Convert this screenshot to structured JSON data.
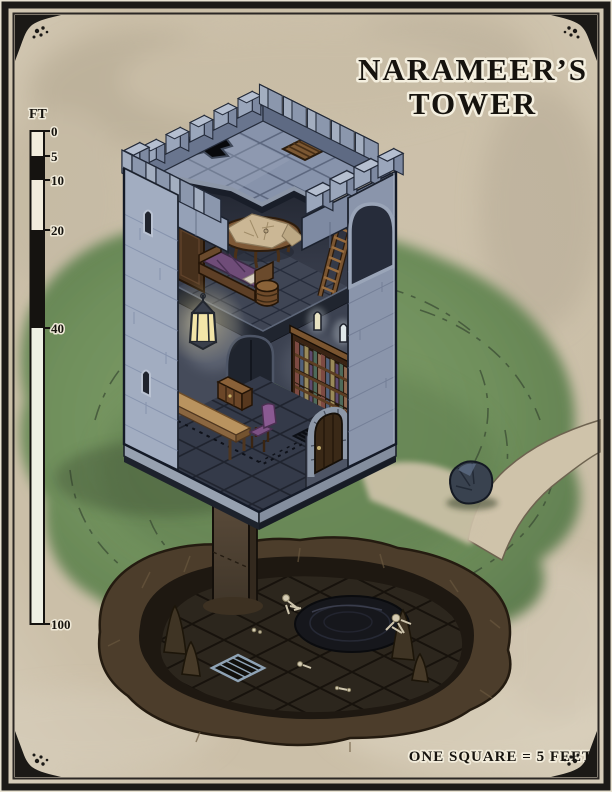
{
  "title": {
    "line1": "NARAMEER’S",
    "line2": "TOWER"
  },
  "legend": {
    "text": "ONE SQUARE = 5 FEET"
  },
  "scale_bar": {
    "unit": "FT",
    "ticks": [
      "0",
      "5",
      "10",
      "20",
      "40",
      "100"
    ],
    "segment_pattern": [
      "light",
      "dark",
      "light",
      "dark",
      "light"
    ]
  },
  "features": {
    "tower": [
      "crenellated-battlements",
      "rooftop-hole",
      "rooftop-trapdoor-grate",
      "study-table-with-map",
      "wooden-ladder",
      "wardrobe",
      "bed",
      "barrel",
      "hanging-lantern",
      "spiral-staircase",
      "bookshelf",
      "writing-desk",
      "chest",
      "chair",
      "floor-grate",
      "arched-wooden-door",
      "arrow-slit-windows",
      "interior-window-slits",
      "support-pillar"
    ],
    "grounds": [
      "grass-clearing",
      "dirt-path",
      "boulder"
    ],
    "cavern": [
      "earthen-cavern",
      "dark-pool",
      "stalagmites",
      "skeletal-remains",
      "cavern-grate"
    ]
  },
  "colors": {
    "parchment": "#cfc4ae",
    "grass": "#7b985f",
    "stone_light": "#a2adc1",
    "stone_shadow": "#8591a8",
    "interior_wall": "#474d5d",
    "cavern_earth": "#4c3d2b",
    "cavern_floor": "#2c261d",
    "pool": "#16171c",
    "wood": "#7a5531",
    "bed_purple": "#6f4c78",
    "lantern_glow": "#f5e6a8",
    "ink": "#16130e",
    "frame": "#1c1a17"
  }
}
